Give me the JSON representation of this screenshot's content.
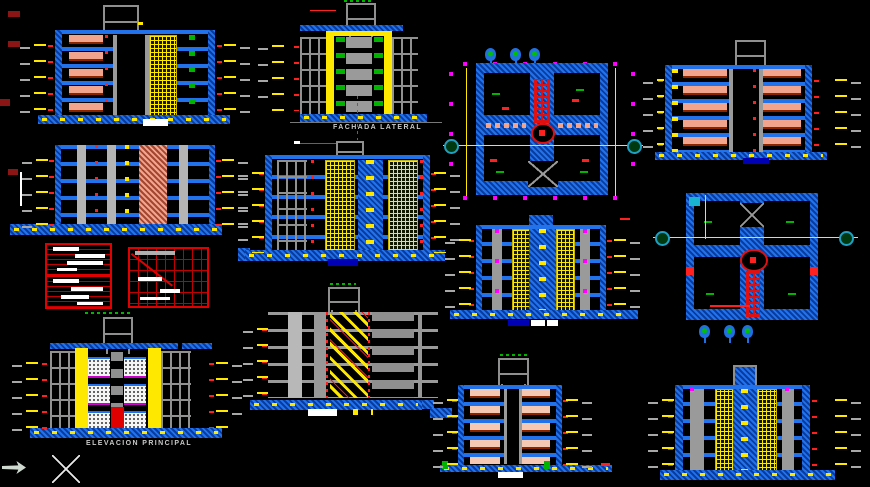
{
  "app": {
    "kind": "cad-model-space",
    "background": "#000000"
  },
  "labels": {
    "fachada_lateral": "FACHADA  LATERAL",
    "elevacion_principal": "ELEVACION  PRINCIPAL"
  },
  "palette": {
    "wall_blue": "#2272ec",
    "wall_blue_dark": "#0a3ca0",
    "label_blue": "#0000b4",
    "yellow": "#ffe800",
    "salmon": "#f2a48c",
    "gray": "#9a9a9a",
    "red": "#e01010",
    "dark_red": "#8b1414",
    "magenta": "#ff00ff",
    "green": "#00b400",
    "teal": "#20a0c0",
    "white": "#ffffff"
  },
  "drawings": [
    {
      "name": "building-section-upper-left",
      "kind": "section",
      "floors": 5
    },
    {
      "name": "building-section-mid-left",
      "kind": "section",
      "floors": 5
    },
    {
      "name": "finish-schedule-tables",
      "kind": "detail-tables",
      "tables": 3
    },
    {
      "name": "elevacion-principal",
      "kind": "elevation",
      "floors": 5,
      "label_key": "elevacion_principal"
    },
    {
      "name": "fachada-lateral",
      "kind": "elevation",
      "floors": 5,
      "label_key": "fachada_lateral"
    },
    {
      "name": "section-center-left",
      "kind": "section",
      "floors": 5
    },
    {
      "name": "stair-section",
      "kind": "section",
      "floors": 5
    },
    {
      "name": "floor-plan-upper",
      "kind": "plan"
    },
    {
      "name": "section-center",
      "kind": "section",
      "floors": 5
    },
    {
      "name": "building-section-upper-right",
      "kind": "section",
      "floors": 5
    },
    {
      "name": "floor-plan-right",
      "kind": "plan"
    },
    {
      "name": "section-bottom-center",
      "kind": "section",
      "floors": 5
    },
    {
      "name": "section-bottom-right",
      "kind": "section",
      "floors": 5
    }
  ],
  "cursor": {
    "pointer_icon": "selection-arrow",
    "crosshair_icon": "x-crosshair"
  }
}
